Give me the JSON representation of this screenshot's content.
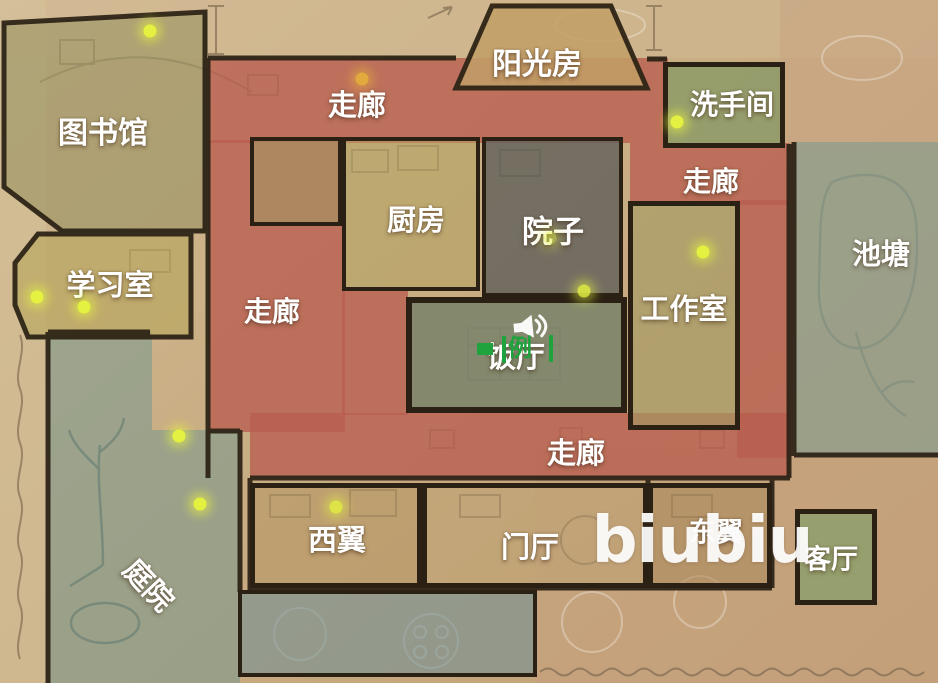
{
  "watermark": "biubiu",
  "colors": {
    "paper": "#c9ad83",
    "corridor_red": "rgba(184,93,79,0.78)",
    "wall_dark": "#2a2114",
    "label_white": "#ffffff",
    "dot_yellow": "#e4f141",
    "dot_orange": "#e2a93e",
    "marker_green": "#1ea33e",
    "garden_teal": "rgba(110,150,143,0.5)",
    "pond_gray_green": "rgba(138,156,142,0.72)"
  },
  "labels": [
    {
      "id": "sunroom",
      "text": "阳光房",
      "x": 537,
      "y": 61,
      "size": 30
    },
    {
      "id": "corridor-top",
      "text": "走廊",
      "x": 357,
      "y": 103,
      "size": 29
    },
    {
      "id": "bathroom",
      "text": "洗手间",
      "x": 732,
      "y": 103,
      "size": 28
    },
    {
      "id": "library",
      "text": "图书馆",
      "x": 103,
      "y": 130,
      "size": 30
    },
    {
      "id": "corridor-right",
      "text": "走廊",
      "x": 711,
      "y": 180,
      "size": 28
    },
    {
      "id": "kitchen",
      "text": "厨房",
      "x": 416,
      "y": 218,
      "size": 29
    },
    {
      "id": "courtyard",
      "text": "院子",
      "x": 553,
      "y": 229,
      "size": 31
    },
    {
      "id": "pond",
      "text": "池塘",
      "x": 881,
      "y": 252,
      "size": 29
    },
    {
      "id": "study",
      "text": "学习室",
      "x": 110,
      "y": 283,
      "size": 29
    },
    {
      "id": "corridor-left",
      "text": "走廊",
      "x": 272,
      "y": 310,
      "size": 28
    },
    {
      "id": "workshop",
      "text": "工作室",
      "x": 684,
      "y": 307,
      "size": 29
    },
    {
      "id": "dining",
      "text": "饭厅",
      "x": 516,
      "y": 355,
      "size": 29
    },
    {
      "id": "corridor-bottom",
      "text": "走廊",
      "x": 576,
      "y": 451,
      "size": 29
    },
    {
      "id": "east-wing",
      "text": "东翼",
      "x": 716,
      "y": 530,
      "size": 27
    },
    {
      "id": "west-wing",
      "text": "西翼",
      "x": 337,
      "y": 538,
      "size": 29
    },
    {
      "id": "foyer",
      "text": "门厅",
      "x": 530,
      "y": 545,
      "size": 29
    },
    {
      "id": "living-room",
      "text": "客厅",
      "x": 831,
      "y": 557,
      "size": 27
    },
    {
      "id": "garden",
      "text": "庭院",
      "x": 150,
      "y": 584,
      "size": 29,
      "rot": 47
    }
  ],
  "regions": [
    {
      "id": "garden-upper",
      "x": 48,
      "y": 332,
      "w": 104,
      "h": 351,
      "bg": "rgba(110,150,143,0.5)",
      "border": 0
    },
    {
      "id": "garden-lower",
      "x": 152,
      "y": 430,
      "w": 88,
      "h": 253,
      "bg": "rgba(110,150,143,0.5)",
      "border": 0
    },
    {
      "id": "terrace",
      "x": 238,
      "y": 590,
      "w": 299,
      "h": 87,
      "bg": "rgba(105,140,150,0.55)",
      "border": 4
    },
    {
      "id": "pond",
      "x": 795,
      "y": 142,
      "w": 143,
      "h": 314,
      "bg": "rgba(138,156,142,0.72)",
      "border": 0
    },
    {
      "id": "library",
      "x": 3,
      "y": 10,
      "w": 204,
      "h": 222,
      "bg": "rgba(152,147,98,0.6)",
      "border": 0,
      "clip": "polygon(0% 6%,100% 1%,100% 100%,29% 100%,0% 80%)"
    },
    {
      "id": "study",
      "x": 14,
      "y": 233,
      "w": 178,
      "h": 105,
      "bg": "rgba(182,167,92,0.62)",
      "border": 0,
      "clip": "polygon(13% 1%,100% 1%,100% 100%,8% 100%,0% 69%,0% 29%)"
    },
    {
      "id": "pantry",
      "x": 250,
      "y": 137,
      "w": 92,
      "h": 89,
      "bg": "rgba(160,154,100,0.55)",
      "border": 4
    },
    {
      "id": "kitchen",
      "x": 342,
      "y": 137,
      "w": 138,
      "h": 154,
      "bg": "rgba(178,162,94,0.55)",
      "border": 4
    },
    {
      "id": "courtyard",
      "x": 482,
      "y": 137,
      "w": 141,
      "h": 160,
      "bg": "rgba(95,95,90,0.8)",
      "border": 4
    },
    {
      "id": "workshop",
      "x": 628,
      "y": 201,
      "w": 112,
      "h": 229,
      "bg": "rgba(161,155,98,0.6)",
      "border": 5
    },
    {
      "id": "sunroom",
      "x": 455,
      "y": 3,
      "w": 193,
      "h": 86,
      "bg": "rgba(194,159,102,0.85)",
      "border": 0,
      "clip": "polygon(19% 0%,81% 0%,100% 100%,0% 100%)"
    },
    {
      "id": "bathroom",
      "x": 663,
      "y": 62,
      "w": 122,
      "h": 86,
      "bg": "rgba(138,154,102,0.8)",
      "border": 5
    },
    {
      "id": "dining",
      "x": 406,
      "y": 297,
      "w": 221,
      "h": 116,
      "bg": "rgba(124,133,106,0.9)",
      "border": 6
    },
    {
      "id": "west-wing",
      "x": 250,
      "y": 483,
      "w": 172,
      "h": 105,
      "bg": "rgba(180,148,95,0.5)",
      "border": 5
    },
    {
      "id": "foyer",
      "x": 422,
      "y": 483,
      "w": 226,
      "h": 105,
      "bg": "rgba(187,159,111,0.4)",
      "border": 5
    },
    {
      "id": "east-wing",
      "x": 648,
      "y": 483,
      "w": 124,
      "h": 105,
      "bg": "rgba(169,136,90,0.55)",
      "border": 5
    },
    {
      "id": "living-room",
      "x": 795,
      "y": 509,
      "w": 82,
      "h": 96,
      "bg": "rgba(139,160,107,0.8)",
      "border": 5
    }
  ],
  "corridors": [
    {
      "x": 208,
      "y": 58,
      "w": 460,
      "h": 85
    },
    {
      "x": 208,
      "y": 140,
      "w": 137,
      "h": 292
    },
    {
      "x": 630,
      "y": 143,
      "w": 160,
      "h": 62
    },
    {
      "x": 737,
      "y": 200,
      "w": 53,
      "h": 258
    },
    {
      "x": 250,
      "y": 413,
      "w": 540,
      "h": 65
    },
    {
      "x": 342,
      "y": 291,
      "w": 66,
      "h": 124
    }
  ],
  "dots": [
    {
      "x": 150,
      "y": 31
    },
    {
      "x": 362,
      "y": 79,
      "c": "#e2a93e"
    },
    {
      "x": 677,
      "y": 122
    },
    {
      "x": 703,
      "y": 252
    },
    {
      "x": 550,
      "y": 238,
      "o": 0.5
    },
    {
      "x": 584,
      "y": 291,
      "o": 0.85
    },
    {
      "x": 37,
      "y": 297
    },
    {
      "x": 84,
      "y": 307
    },
    {
      "x": 179,
      "y": 436
    },
    {
      "x": 200,
      "y": 504
    },
    {
      "x": 336,
      "y": 507,
      "o": 0.85
    }
  ],
  "audio_marker": {
    "overlay_text": "例"
  }
}
